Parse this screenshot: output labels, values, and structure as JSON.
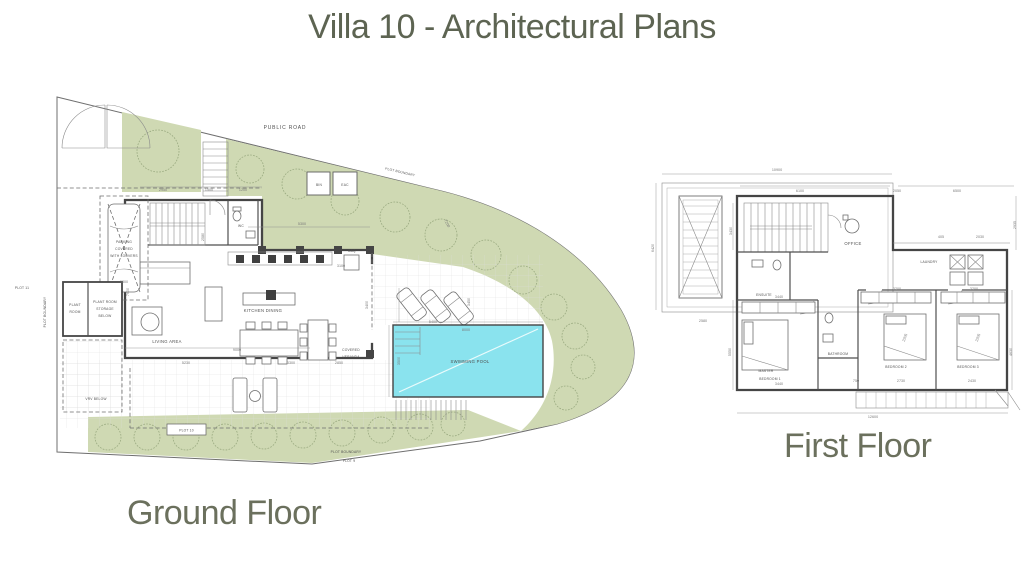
{
  "page": {
    "title": "Villa 10 - Architectural Plans"
  },
  "colors": {
    "accent_text": "#5d6452",
    "landscape_green": "#cfd9b3",
    "tree_line": "#9aaa80",
    "pool_fill": "#8ae3ee",
    "wall": "#454545",
    "line": "#8a8a8a",
    "dim_text": "#7a7a7a"
  },
  "ground_floor": {
    "caption": "Ground Floor",
    "site": {
      "public_road": "PUBLIC ROAD",
      "plot_boundary": "PLOT BOUNDARY",
      "plot_9": "PLOT 9",
      "plot_10": "PLOT 10",
      "plot_11": "PLOT 11"
    },
    "rooms": {
      "living_area": "LIVING AREA",
      "kitchen_dining": "KITCHEN DINING",
      "covered_veranda": [
        "COVERED",
        "VERANDA"
      ],
      "swimming_pool": "SWIMMING POOL",
      "wc": "WC",
      "bbq": "BBQ",
      "bin": "BIN",
      "eac": "EAC",
      "plant_room": [
        "PLANT",
        "ROOM"
      ],
      "plant_storage": [
        "PLANT ROOM",
        "STORAGE",
        "BELOW"
      ],
      "parking": [
        "PARKING",
        "COVERED",
        "WITH LOUVERS"
      ],
      "vrv_below": "VRV BELOW"
    },
    "dims": {
      "d2950": "2950",
      "d1500": "1500",
      "d1200": "1200",
      "d5300": "5300",
      "d3100": "3100",
      "d7200": "7200",
      "d7600": "7600",
      "d9000": "9000",
      "d5230": "5230",
      "d3300": "3300",
      "d2850": "2850",
      "d8000": "8000",
      "d3500": "3500",
      "d5400": "5400",
      "d3450": "3450",
      "d3400": "3400",
      "d2580": "2580",
      "d3300_parking": "3300"
    }
  },
  "first_floor": {
    "caption": "First Floor",
    "rooms": {
      "office": "OFFICE",
      "ensuite": "ENSUITE",
      "laundry": "LAUNDRY",
      "master_bedroom": [
        "MASTER",
        "BEDROOM 1"
      ],
      "bathroom": "BATHROOM",
      "bedroom_2": "BEDROOM 2",
      "bedroom_3": "BEDROOM 3"
    },
    "dims": {
      "d10900": "10900",
      "d6100": "6100",
      "d6500": "6500",
      "d2050": "2050",
      "d405": "405",
      "d2030": "2030",
      "d3430": "3430",
      "d6420": "6420",
      "d2580": "2580",
      "d5550": "5550",
      "d3440": "3440",
      "d3200": "3200",
      "d2205": "2205",
      "d2730": "2730",
      "d2430": "2430",
      "d750": "750",
      "d12600": "12600",
      "d4630": "4630",
      "d2935": "2935"
    }
  }
}
